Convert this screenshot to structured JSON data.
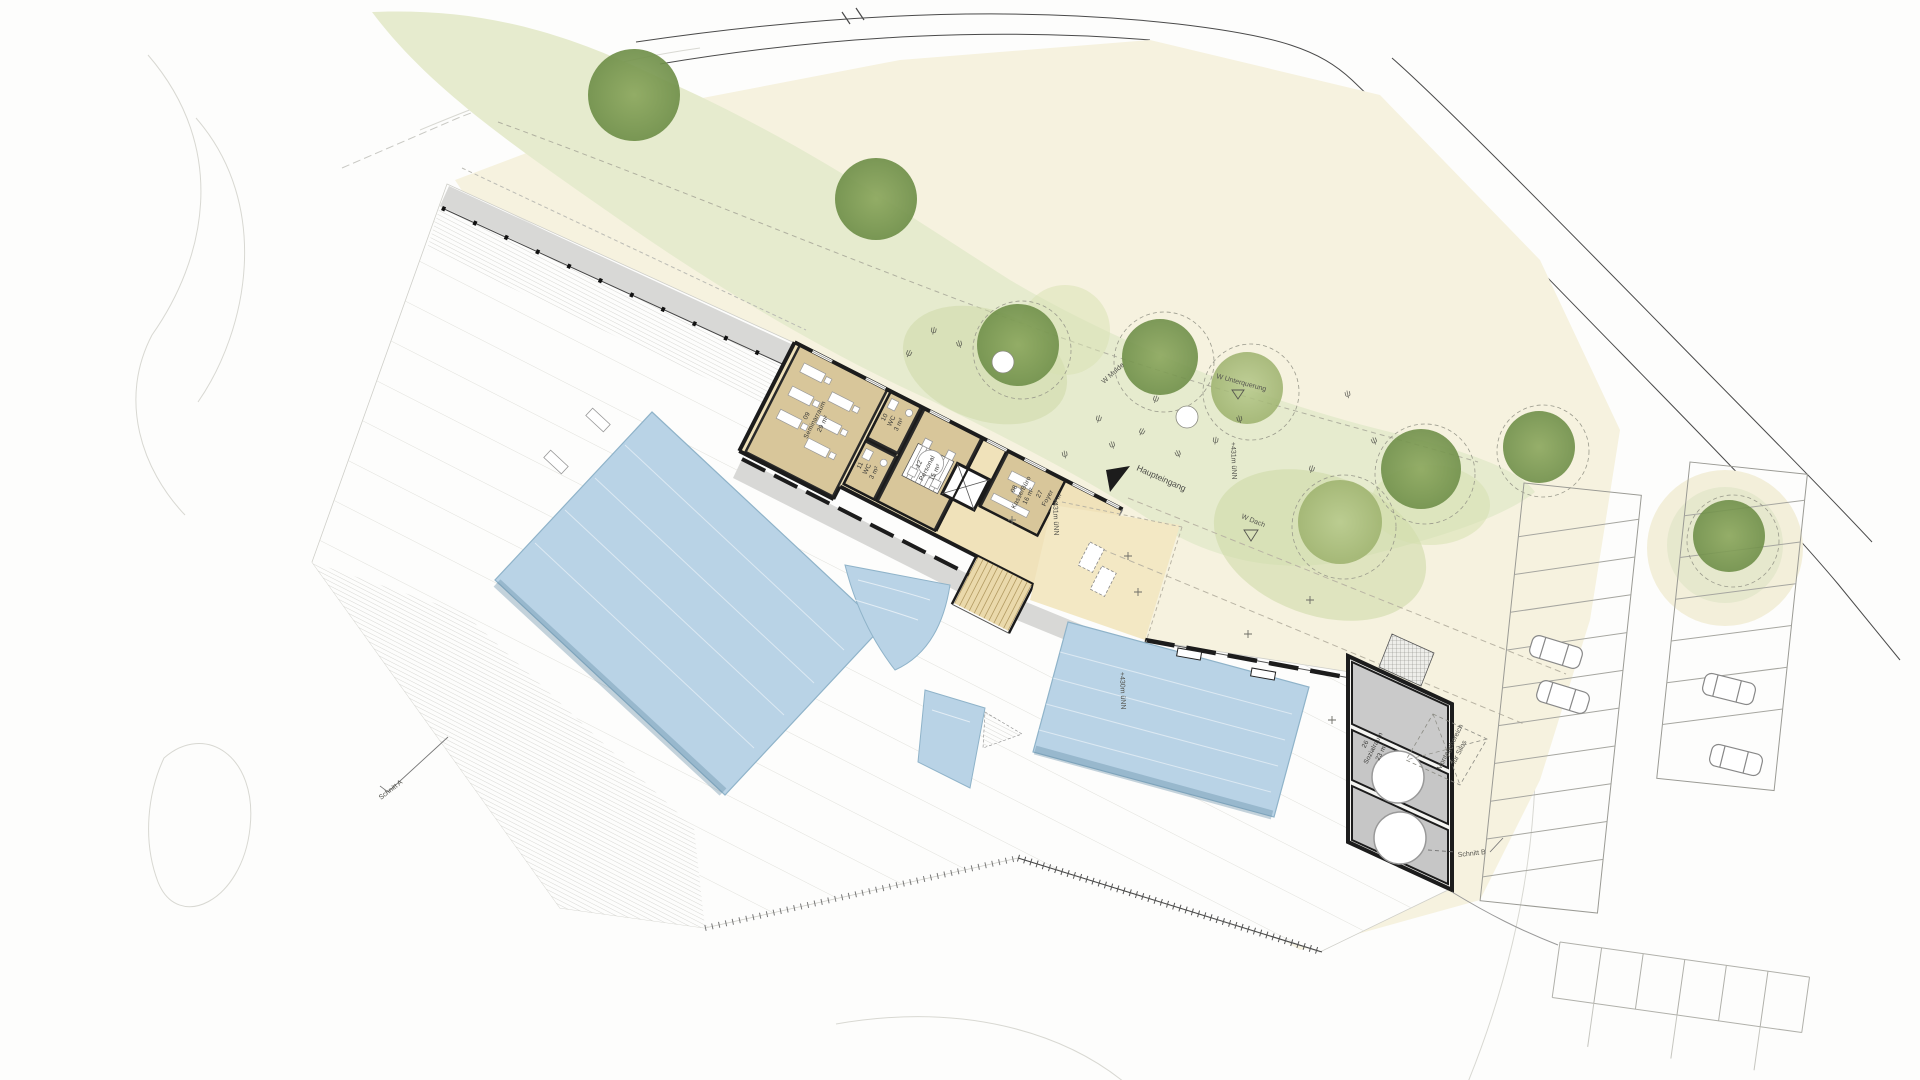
{
  "drawing": {
    "rooms": [
      {
        "num": "09",
        "name": "Seminarraum",
        "area": "29 m²"
      },
      {
        "num": "10",
        "name": "WC",
        "area": "3 m²"
      },
      {
        "num": "11",
        "name": "WC",
        "area": "3 m²"
      },
      {
        "num": "12",
        "name": "Personal",
        "area": "15 m²"
      },
      {
        "num": "08",
        "name": "Kasse/Büro",
        "area": "16 m²"
      },
      {
        "num": "27",
        "name": "Foyer",
        "area": "97,3 m²"
      },
      {
        "num": "26",
        "name": "Sozialraum",
        "area": "23 m²"
      }
    ],
    "labels": {
      "entrance": "Haupteingang",
      "w_dach": "W Dach",
      "w_mulde": "W Mulde",
      "w_unterquerung": "W Unterquerung",
      "montage_line1": "Montagebereich",
      "montage_line2": "für Silos",
      "section_a": "Schnitt A",
      "section_b": "Schnitt B",
      "level_431_path": "+431m üNN",
      "level_431_foyer": "+431m üNN",
      "level_430_deck": "+430m üNN"
    },
    "symbols": {
      "plant": "ψ"
    },
    "colors": {
      "water": "#b9d3e6",
      "water_edge": "#8fb3c9",
      "lawn": "#e6ebce",
      "tree_dark": "#7e9a50",
      "tree_light": "#aabd7c",
      "cream": "#f6f2df",
      "room_tan": "#d8c69a",
      "foyer_tan": "#f0e2ba",
      "path_grey": "#d8d8d6",
      "wall_dark": "#1c1c1c",
      "plant_room_grey": "#cacaca"
    }
  }
}
